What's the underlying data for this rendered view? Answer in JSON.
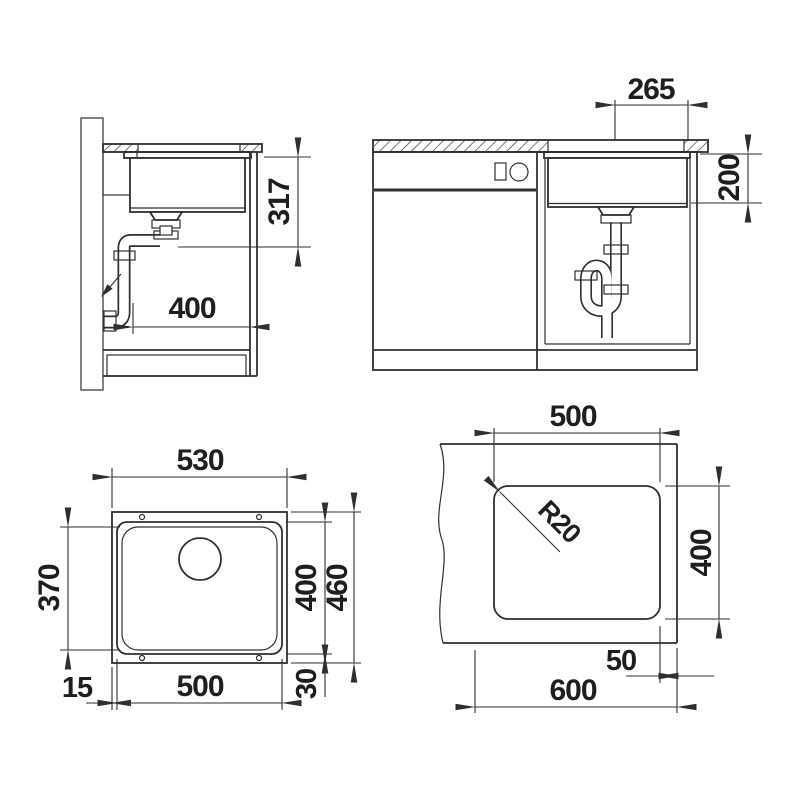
{
  "drawing_title": "Sink installation dimensional drawing",
  "colors": {
    "line": "#2f2f2f",
    "background": "#ffffff",
    "text": "#1e1e1e"
  },
  "dims": {
    "side_section": {
      "clearance": "317",
      "depth": "400"
    },
    "front_view": {
      "center_to_edge": "265",
      "bowl_depth": "200"
    },
    "top_view": {
      "overall_width": "530",
      "floor_depth": "370",
      "bowl_depth": "400",
      "overall_depth": "460",
      "side_offset": "15",
      "bowl_width": "500",
      "bottom_offset": "30"
    },
    "cutout_view": {
      "width": "500",
      "corner_radius": "R20",
      "depth": "400",
      "edge_distance": "50",
      "worktop_width": "600"
    }
  }
}
